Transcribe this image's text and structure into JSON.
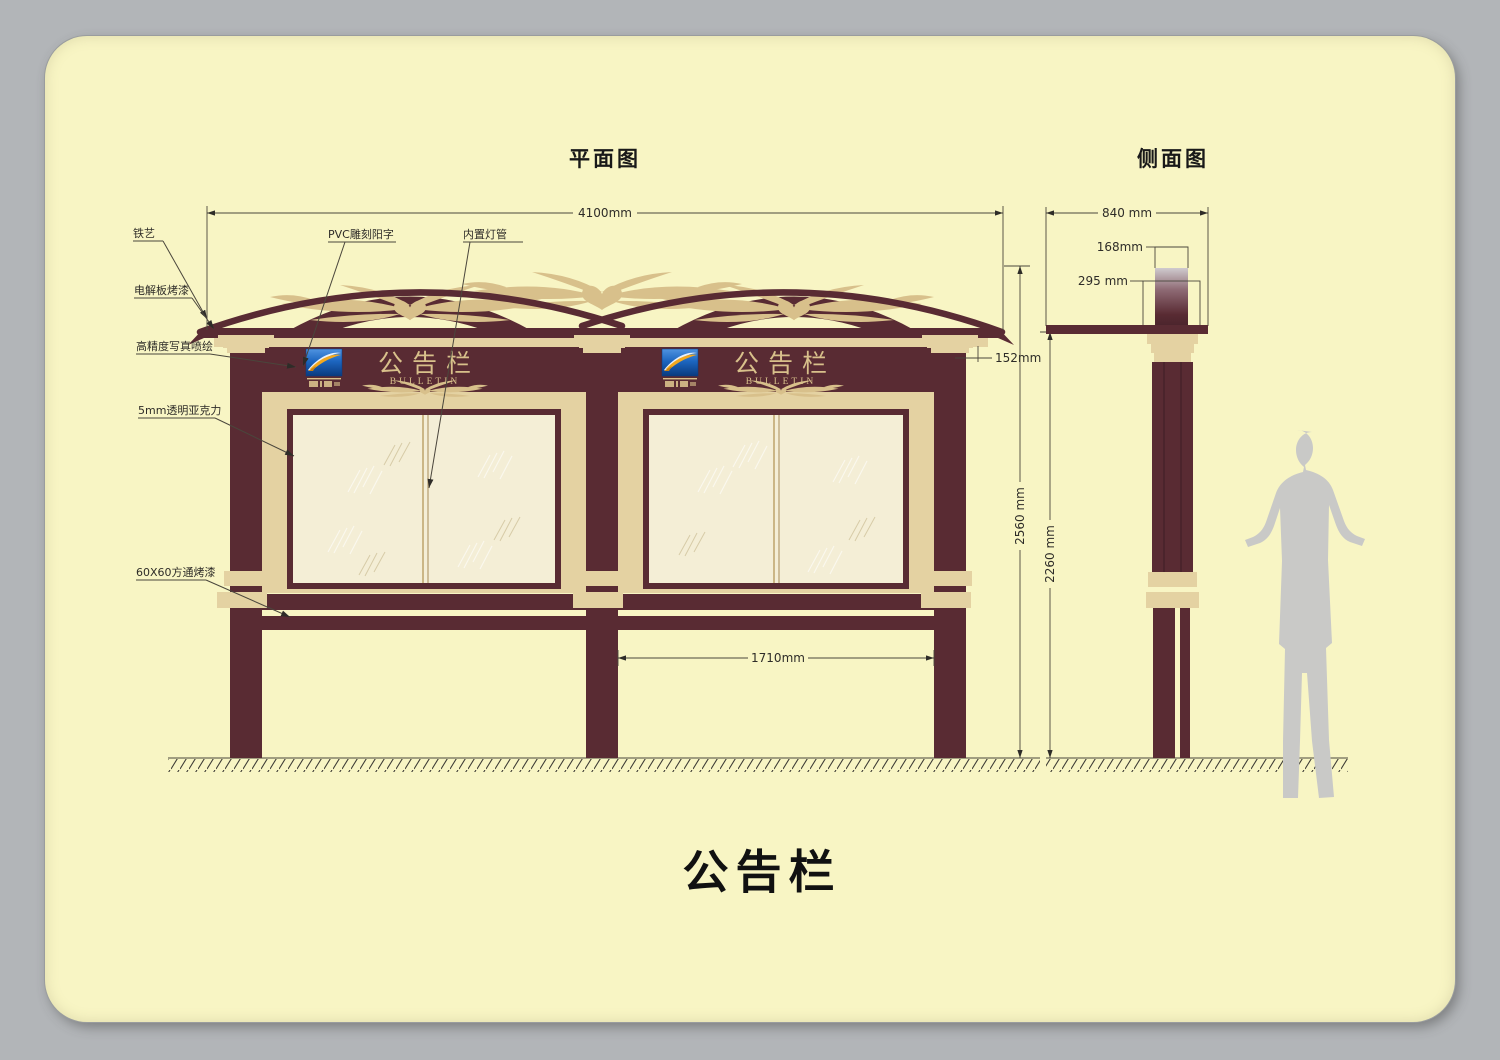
{
  "canvas": {
    "width": 1500,
    "height": 1060
  },
  "colors": {
    "bg": "#b2b5b8",
    "card": "#f8f5c4",
    "maroon": "#592b33",
    "maroon-dark": "#46222a",
    "tan": "#e4d2a2",
    "tan2": "#d8c08b",
    "window": "#f4eed6",
    "ink": "#2e2c28",
    "line": "#4a463c",
    "silhouette": "#c9c9c7",
    "logo-blue": "#1d66c0",
    "logo-blue-dark": "#0a3a7e",
    "logo-gold": "#f2a81e"
  },
  "titles": {
    "front_view": "平面图",
    "side_view": "侧面图",
    "caption": "公告栏"
  },
  "board": {
    "name_cn": "公告栏",
    "name_en": "BULLETIN"
  },
  "callouts": {
    "iron_art": "铁艺",
    "electro_plate": "电解板烤漆",
    "hi_res_print": "高精度写真喷绘",
    "acrylic": "5mm透明亚克力",
    "square_tube": "60X60方通烤漆",
    "pvc_letters": "PVC雕刻阳字",
    "inner_lamp": "内置灯管"
  },
  "dimensions": {
    "total_width": "4100mm",
    "header_height": "152mm",
    "overall_height": "2560 mm",
    "post_height": "2260 mm",
    "leg_spacing": "1710mm",
    "side_width": "840 mm",
    "cap_depth": "168mm",
    "cap_height": "295 mm"
  }
}
